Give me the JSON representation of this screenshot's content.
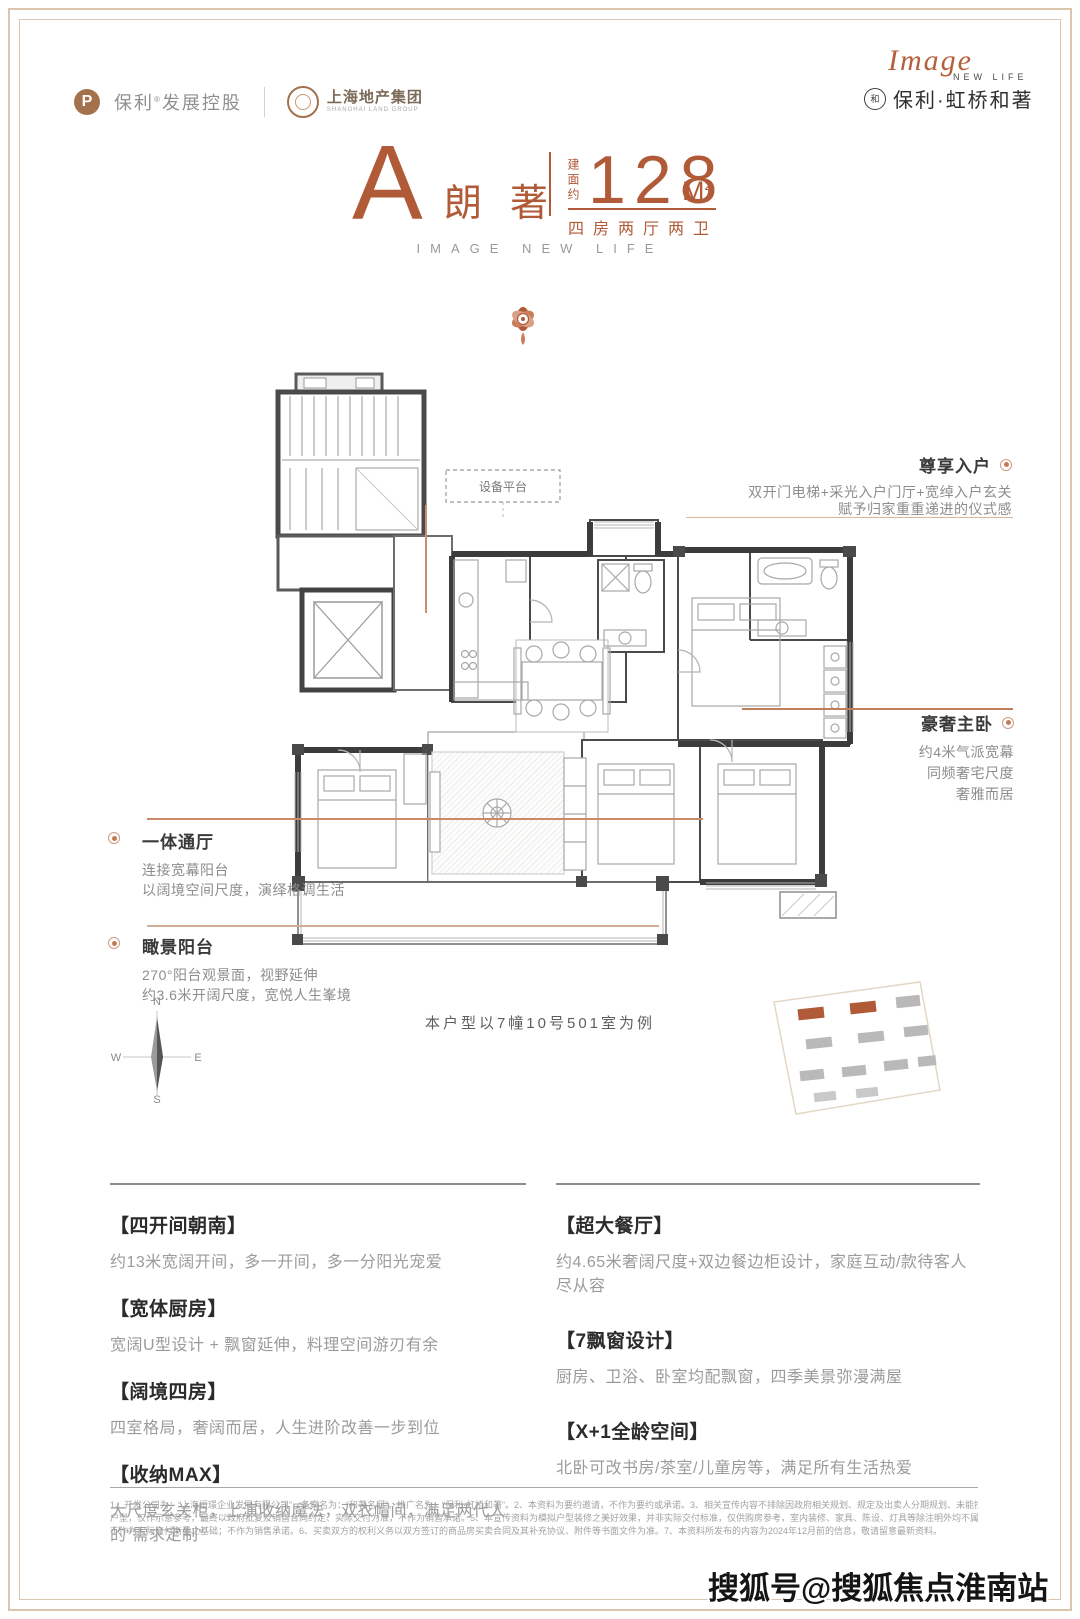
{
  "colors": {
    "accent": "#b15a38",
    "frame": "#dcc4ad",
    "wall": "#474747",
    "gray_text": "#9b9b9b"
  },
  "header": {
    "poly_initial": "P",
    "poly_brand": "保利",
    "poly_reg": "®",
    "poly_suffix": "发展控股",
    "shland_name": "上海地产集团",
    "shland_sub": "SHANGHAI LAND GROUP",
    "image_script": "Image",
    "image_sub": "NEW LIFE",
    "seal_glyph": "和",
    "project_name": "保利·虹桥和著"
  },
  "title_block": {
    "unit_letter": "A",
    "unit_name": "朗著",
    "area_label": "建面约",
    "area_value": "128",
    "area_unit": "M",
    "area_sup": "2",
    "rooms": "四房两厅两卫",
    "slogan": "IMAGE NEW LIFE"
  },
  "floorplan": {
    "equipment_platform": "设备平台",
    "caption": "本户型以7幢10号501室为例"
  },
  "annotations": {
    "entry": {
      "title": "尊享入户",
      "line1": "双开门电梯+采光入户门厅+宽绰入户玄关",
      "line2": "赋予归家重重递进的仪式感"
    },
    "master": {
      "title": "豪奢主卧",
      "line1": "约4米气派宽幕",
      "line2": "同频奢宅尺度",
      "line3": "奢雅而居"
    },
    "living": {
      "title": "一体通厅",
      "line1": "连接宽幕阳台",
      "line2": "以阔境空间尺度，演绎格调生活"
    },
    "balcony": {
      "title": "瞰景阳台",
      "line1": "270°阳台观景面，视野延伸",
      "line2": "约3.6米开阔尺度，宽悦人生峯境"
    }
  },
  "compass": {
    "north": "N",
    "east": "E",
    "south": "S",
    "west": "W"
  },
  "features": {
    "left": [
      {
        "title": "【四开间朝南】",
        "desc": "约13米宽阔开间，多一开间，多一分阳光宠爱"
      },
      {
        "title": "【宽体厨房】",
        "desc": "宽阔U型设计 + 飘窗延伸，料理空间游刃有余"
      },
      {
        "title": "【阔境四房】",
        "desc": "四室格局，奢阔而居，人生进阶改善一步到位"
      },
      {
        "title": "【收纳MAX】",
        "desc": "大尺度玄关柜，上演收纳魔法，双衣帽间，满足两代人的“需求定制”"
      }
    ],
    "right": [
      {
        "title": "【超大餐厅】",
        "desc": "约4.65米奢阔尺度+双边餐边柜设计，家庭互动/款待客人尽从容"
      },
      {
        "title": "【7飘窗设计】",
        "desc": "厨房、卫浴、卧室均配飘窗，四季美景弥漫满屋"
      },
      {
        "title": "【X+1全龄空间】",
        "desc": "北卧可改书房/茶室/儿童房等，满足所有生活热爱"
      }
    ]
  },
  "disclaimer": {
    "line1": "1、开发公司为：“上海垣璟企业发展有限公司”，备案名为：“和著名邸”，推广名为：“保利·虹桥和著”。2、本资料为要约邀请，不作为要约或承诺。3、相关宣传内容不排除因政府相关规划、规定及出卖人分期规划、未能控制等原因而发生变化。4、本宣传资料所涉及的",
    "line2": "户型，仅作示意参考，最终以政府批复及销售合同约定、实际交付为准，不作为销售承诺。5、本宣传资料为模拟户型装修之美好效果，并非实际交付标准，仅供购房参考，室内装修、家具、陈设、灯具等除注明外均不属于交付范围，室内外所有面积、尺寸及建筑结构",
    "line3": "不作为实际交付衡量之基础；不作为销售承诺。6、买卖双方的权利义务以双方签订的商品房买卖合同及其补充协议、附件等书面文件为准。7、本资料所发布的内容为2024年12月前的信息，敬请留意最新资料。"
  },
  "watermark": "搜狐号@搜狐焦点淮南站"
}
